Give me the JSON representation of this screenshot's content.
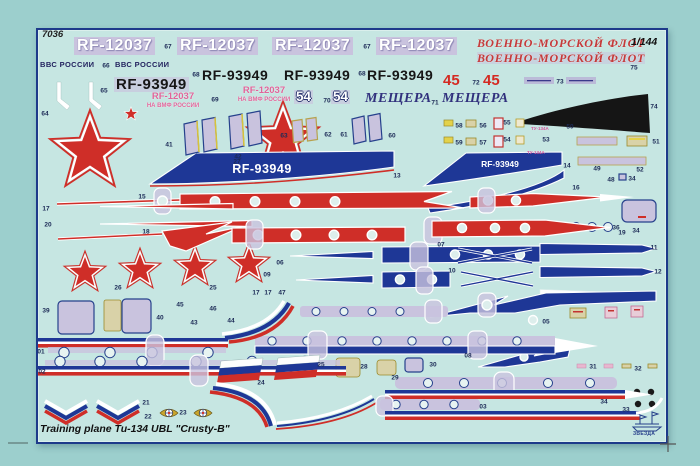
{
  "sheet": {
    "product_code": "7036",
    "scale": "1/144",
    "title": "Training plane Tu-134 UBL \"Crusty-B\"",
    "brand": "ЗВЕЗДА"
  },
  "decal_texts": {
    "rf12037": "RF-12037",
    "rf93949": "RF-93949",
    "vvs_rossii": "ВВС РОССИИ",
    "fleet_title": "ВОЕННО-МОРСКОЙ ФЛОТ",
    "board_num_45": "45",
    "board_num_54": "54",
    "meshchera": "МЕЩЕРА",
    "navmf_line1": "RF-12037",
    "navmf_line2": "НА ВМФ РОССИИ",
    "tu134_stencil": "ТУ-134А"
  },
  "colors": {
    "background": "#9ccfcd",
    "sheet": "#c6e6e2",
    "border_navy": "#1d3a8a",
    "decal_red": "#cf2e28",
    "decal_navy": "#1e3796",
    "carrier_lavender": "#c9c3de",
    "stencil_tan": "#d9d2a8",
    "stencil_yellow": "#e3d24b",
    "stencil_pink": "#e0649a",
    "anti_glare_black": "#151515",
    "white": "#ffffff"
  },
  "part_labels": [
    {
      "t": "67",
      "x": 168,
      "y": 47
    },
    {
      "t": "67",
      "x": 367,
      "y": 47
    },
    {
      "t": "75",
      "x": 634,
      "y": 68
    },
    {
      "t": "66",
      "x": 106,
      "y": 66
    },
    {
      "t": "68",
      "x": 196,
      "y": 75
    },
    {
      "t": "68",
      "x": 362,
      "y": 74
    },
    {
      "t": "72",
      "x": 476,
      "y": 83
    },
    {
      "t": "73",
      "x": 560,
      "y": 82
    },
    {
      "t": "65",
      "x": 104,
      "y": 91
    },
    {
      "t": "69",
      "x": 215,
      "y": 100
    },
    {
      "t": "70",
      "x": 327,
      "y": 101
    },
    {
      "t": "71",
      "x": 435,
      "y": 103
    },
    {
      "t": "64",
      "x": 45,
      "y": 114
    },
    {
      "t": "74",
      "x": 654,
      "y": 107
    },
    {
      "t": "58",
      "x": 459,
      "y": 126
    },
    {
      "t": "56",
      "x": 483,
      "y": 126
    },
    {
      "t": "55",
      "x": 507,
      "y": 123
    },
    {
      "t": "50",
      "x": 570,
      "y": 127
    },
    {
      "t": "63",
      "x": 284,
      "y": 136
    },
    {
      "t": "62",
      "x": 328,
      "y": 135
    },
    {
      "t": "61",
      "x": 344,
      "y": 135
    },
    {
      "t": "60",
      "x": 392,
      "y": 136
    },
    {
      "t": "51",
      "x": 656,
      "y": 142
    },
    {
      "t": "59",
      "x": 459,
      "y": 143
    },
    {
      "t": "57",
      "x": 483,
      "y": 143
    },
    {
      "t": "54",
      "x": 507,
      "y": 140
    },
    {
      "t": "53",
      "x": 546,
      "y": 140
    },
    {
      "t": "41",
      "x": 169,
      "y": 145
    },
    {
      "t": "42",
      "x": 238,
      "y": 157
    },
    {
      "t": "27",
      "x": 237,
      "y": 162
    },
    {
      "t": "14",
      "x": 567,
      "y": 166
    },
    {
      "t": "49",
      "x": 597,
      "y": 169
    },
    {
      "t": "52",
      "x": 640,
      "y": 170
    },
    {
      "t": "13",
      "x": 397,
      "y": 176
    },
    {
      "t": "48",
      "x": 611,
      "y": 180
    },
    {
      "t": "34",
      "x": 632,
      "y": 179
    },
    {
      "t": "16",
      "x": 576,
      "y": 188
    },
    {
      "t": "15",
      "x": 142,
      "y": 197
    },
    {
      "t": "17",
      "x": 46,
      "y": 209
    },
    {
      "t": "20",
      "x": 48,
      "y": 225
    },
    {
      "t": "36",
      "x": 616,
      "y": 228
    },
    {
      "t": "34",
      "x": 636,
      "y": 231
    },
    {
      "t": "18",
      "x": 146,
      "y": 232
    },
    {
      "t": "19",
      "x": 622,
      "y": 233
    },
    {
      "t": "07",
      "x": 441,
      "y": 245
    },
    {
      "t": "11",
      "x": 654,
      "y": 248
    },
    {
      "t": "06",
      "x": 280,
      "y": 263
    },
    {
      "t": "10",
      "x": 452,
      "y": 271
    },
    {
      "t": "12",
      "x": 658,
      "y": 272
    },
    {
      "t": "09",
      "x": 267,
      "y": 275
    },
    {
      "t": "26",
      "x": 118,
      "y": 288
    },
    {
      "t": "25",
      "x": 213,
      "y": 288
    },
    {
      "t": "17",
      "x": 256,
      "y": 293
    },
    {
      "t": "17",
      "x": 268,
      "y": 293
    },
    {
      "t": "47",
      "x": 282,
      "y": 293
    },
    {
      "t": "45",
      "x": 180,
      "y": 305
    },
    {
      "t": "46",
      "x": 213,
      "y": 309
    },
    {
      "t": "39",
      "x": 46,
      "y": 311
    },
    {
      "t": "40",
      "x": 160,
      "y": 318
    },
    {
      "t": "44",
      "x": 231,
      "y": 321
    },
    {
      "t": "05",
      "x": 546,
      "y": 322
    },
    {
      "t": "43",
      "x": 194,
      "y": 323
    },
    {
      "t": "08",
      "x": 468,
      "y": 356
    },
    {
      "t": "01",
      "x": 41,
      "y": 352
    },
    {
      "t": "30",
      "x": 433,
      "y": 365
    },
    {
      "t": "25",
      "x": 321,
      "y": 365
    },
    {
      "t": "28",
      "x": 364,
      "y": 367
    },
    {
      "t": "31",
      "x": 593,
      "y": 367
    },
    {
      "t": "32",
      "x": 638,
      "y": 369
    },
    {
      "t": "02",
      "x": 42,
      "y": 372
    },
    {
      "t": "29",
      "x": 395,
      "y": 378
    },
    {
      "t": "24",
      "x": 261,
      "y": 383
    },
    {
      "t": "34",
      "x": 604,
      "y": 402
    },
    {
      "t": "21",
      "x": 146,
      "y": 403
    },
    {
      "t": "03",
      "x": 483,
      "y": 407
    },
    {
      "t": "33",
      "x": 626,
      "y": 410
    },
    {
      "t": "23",
      "x": 183,
      "y": 413
    },
    {
      "t": "22",
      "x": 148,
      "y": 417
    }
  ]
}
